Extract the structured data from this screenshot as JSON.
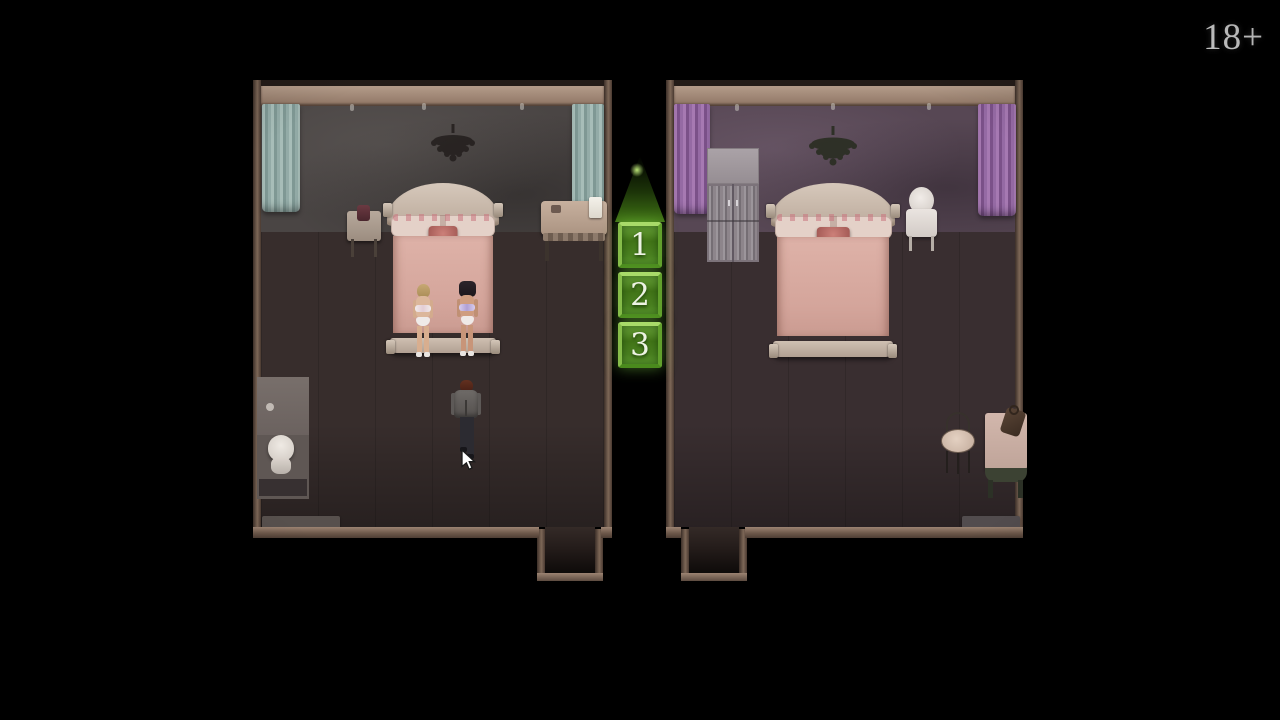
{
  "hud": {
    "age_rating": "18+"
  },
  "choices": {
    "buttons": [
      {
        "label": "1"
      },
      {
        "label": "2"
      },
      {
        "label": "3"
      }
    ],
    "accent_color": "#7fc142"
  },
  "palette": {
    "background": "#000000",
    "wall_trim": "#8a7263",
    "left_room_wall": "#4a4544",
    "right_room_wall": "#574754",
    "floor": "#372d2c",
    "bed_blanket": "#d5a79e",
    "bed_frame": "#cbbcae",
    "curtain_teal": "#95b1ad",
    "curtain_purple": "#9568a3",
    "button_green_face": "#4a8120",
    "button_green_border": "#a8da69",
    "text_white": "#f4f4f4"
  }
}
